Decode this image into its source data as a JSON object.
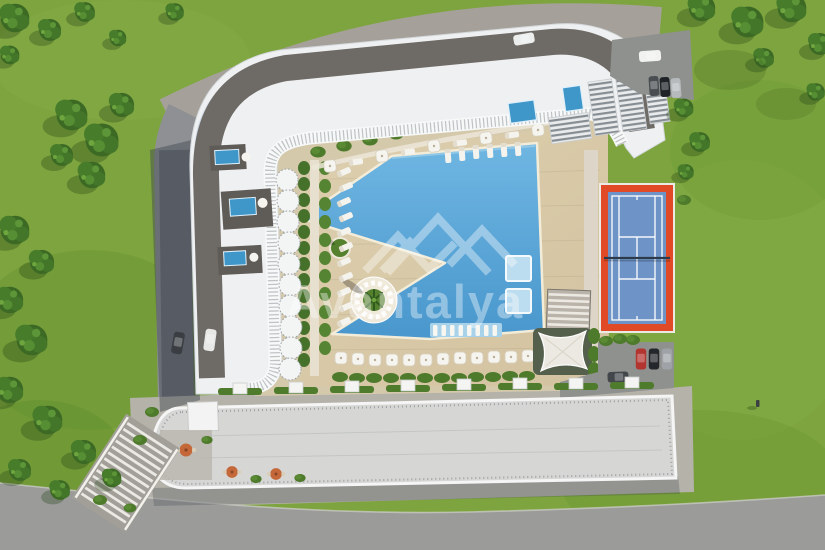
{
  "scene": {
    "type": "aerial-3d-architectural-render",
    "subject": "Top-down site plan render of a residential resort complex with curved apartment block, free-form swimming pool, sun deck, gardens and tennis court"
  },
  "watermark": {
    "text": "Avantalya",
    "logo": "mountain-peaks-icon",
    "color": "#ffffff"
  },
  "palette": {
    "grass": "#7da43e",
    "grass_shade": "#5d8a2e",
    "tree_canopy": "#3c6a25",
    "road_asphalt": "#9b9c99",
    "cobble_road": "#a5a19a",
    "pavement": "#b5b2aa",
    "deck_light": "#ddcfae",
    "deck": "#d3c2a0",
    "pool_light": "#6fb6e2",
    "pool": "#4997cd",
    "pool_ledge": "#a7d2ea",
    "hedge": "#4e7a2b",
    "roof_dark": "#6e6a66",
    "building_white": "#eef0f2",
    "glass_blue": "#c9d8e4",
    "court_red": "#e14a26",
    "court_blue": "#6e94c7",
    "net_dark": "#2c3b4a",
    "rooftop_pool": "#3f96c9",
    "parasol_orange": "#c4683a",
    "shadow_blue": "#3d4450"
  },
  "features": [
    {
      "name": "main-building",
      "desc": "white curved apartment block with dark roof band, glass-blue edges, scalloped balconies and three rooftop pools"
    },
    {
      "name": "swimming-pool",
      "desc": "free-form blue pool with triangular deck wedge, palm island, tanning ledge with in-water loungers and two swim platforms"
    },
    {
      "name": "tennis-court",
      "desc": "blue hard court with white lines, net at mid-court and orange-red surround"
    },
    {
      "name": "clubhouse-building",
      "desc": "long flat-roof building along the bottom with railing, entrance canopies and terrace seating"
    },
    {
      "name": "grand-staircase",
      "desc": "wide stepped stairway at lower left leading to street"
    },
    {
      "name": "pergola-and-shade-sail",
      "desc": "louvered pergola and white shade sail east of the pool"
    },
    {
      "name": "gardens",
      "desc": "lawns, hedges, tree groves along left edge and top-right corner, parasols and loungers"
    }
  ],
  "vehicles": {
    "parking_top_right": [
      "white",
      "dark-gray",
      "black",
      "silver"
    ],
    "parking_mid_right": [
      "red",
      "black",
      "gray",
      "dark-gray"
    ],
    "west_lane": [
      "dark-gray",
      "white-van"
    ],
    "top_road": [
      "white-van"
    ]
  }
}
